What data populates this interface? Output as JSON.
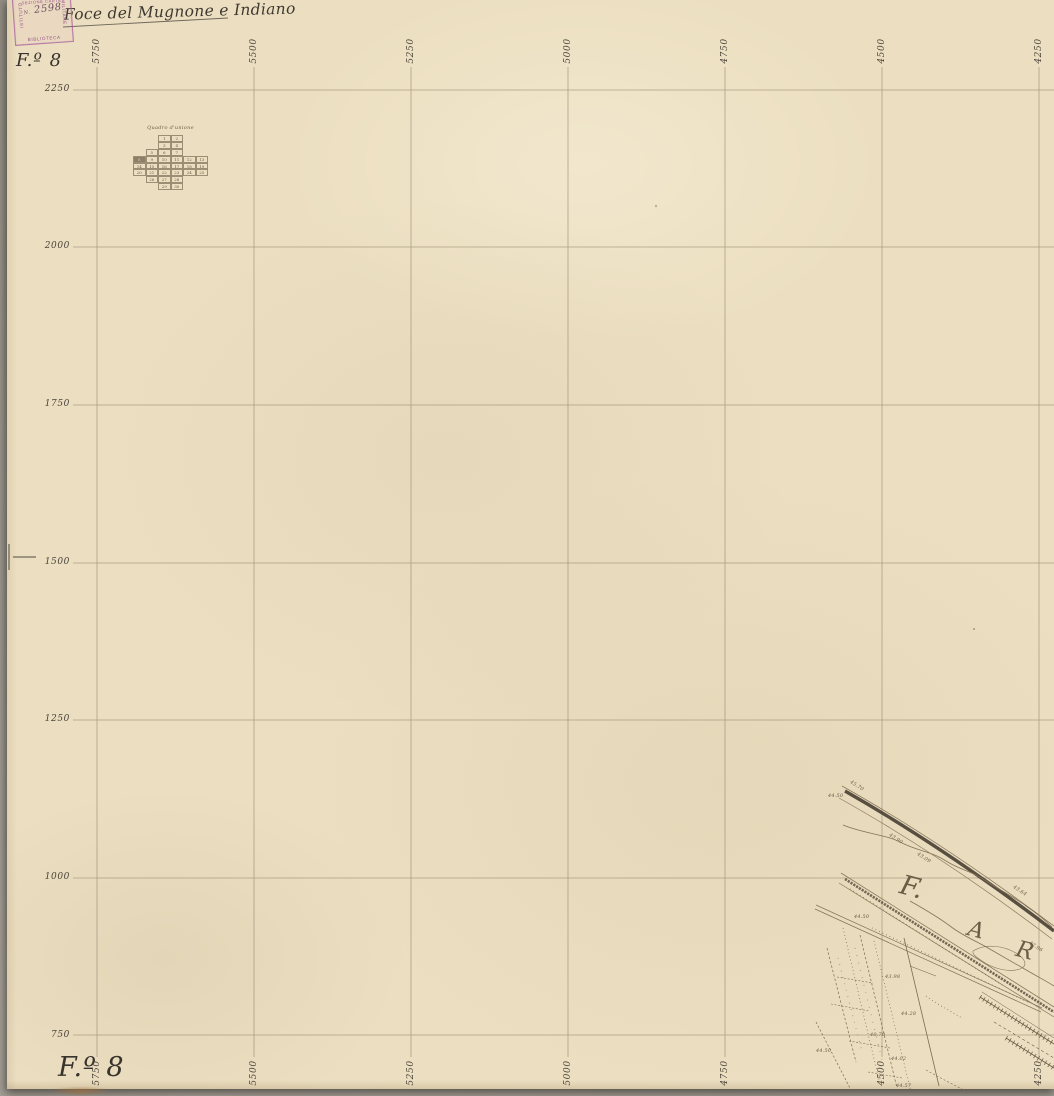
{
  "colors": {
    "paper": "#ecdfc1",
    "background": "#a39e94",
    "grid_line": "#a2937a",
    "label_ink": "#4a443a",
    "map_ink": "#7c6b50",
    "stamp_purple": "#a75d9d"
  },
  "header": {
    "handwritten_title": "Foce del Mugnone e Indiano",
    "folio_label": "F.º 8"
  },
  "footer": {
    "folio_label": "F.º 8"
  },
  "stamp": {
    "left_text": "ISTITUTO",
    "top_text": "GEOGRAFICO",
    "right_text": "MILITARE",
    "section_text": "SEZIONE CARTE",
    "number_prefix": "N.",
    "number": "2598",
    "bottom_text": "BIBLIOTECA"
  },
  "grid": {
    "top_labels": [
      "5750",
      "5500",
      "5250",
      "5000",
      "4750",
      "4500",
      "4250"
    ],
    "bottom_labels": [
      "5750",
      "5500",
      "5250",
      "5000",
      "4750",
      "4500",
      "4250"
    ],
    "left_labels": [
      "2250",
      "2000",
      "1750",
      "1500",
      "1250",
      "1000",
      "750"
    ]
  },
  "quadro": {
    "title": "Quadro d'unione",
    "highlighted_cell": "8",
    "cells": [
      "1",
      "2",
      "3",
      "4",
      "5",
      "6",
      "7",
      "8",
      "9",
      "10",
      "11",
      "12",
      "13",
      "14",
      "15",
      "16",
      "17",
      "18",
      "19",
      "20",
      "21",
      "22",
      "23",
      "24",
      "25",
      "26",
      "27",
      "28",
      "29",
      "30"
    ]
  },
  "map_detail": {
    "river_letters": [
      "F.",
      "A",
      "R"
    ],
    "spot_heights": [
      "45.70",
      "44.50",
      "43.90",
      "43.09",
      "43.64",
      "44.50",
      "43.98",
      "44.28",
      "40.70",
      "44.02",
      "44.57",
      "42.96",
      "44.50"
    ]
  }
}
